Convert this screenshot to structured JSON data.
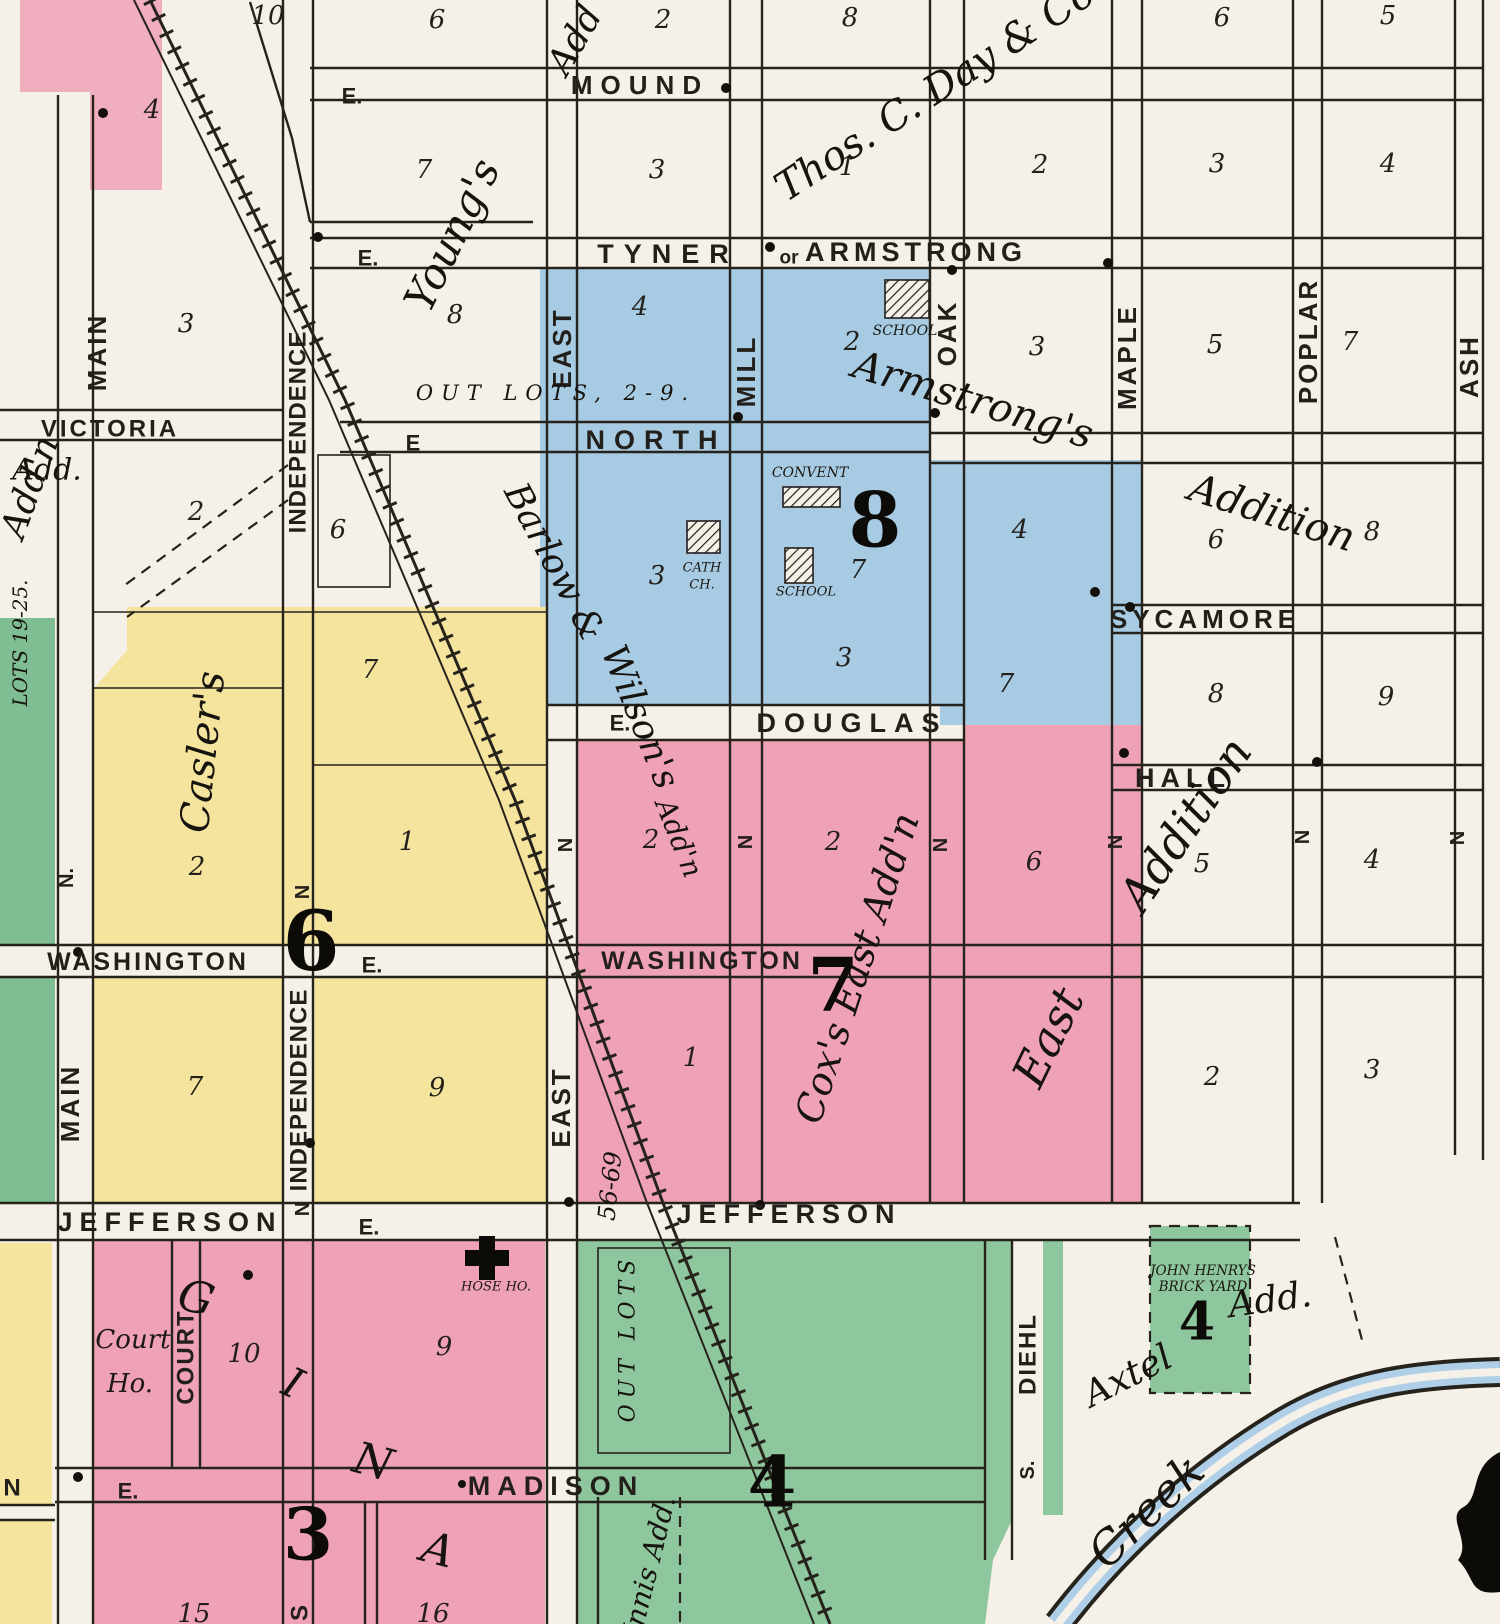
{
  "colors": {
    "paper": "#f5f1e8",
    "pink": "#efa2b6",
    "pink_light": "#f0aebf",
    "blue": "#a6cbe3",
    "yellow": "#f4e49e",
    "green": "#8ec79d",
    "green_strip": "#7fbd92",
    "creek_blue": "#aecfe7",
    "ink": "#231f1a"
  },
  "streets": {
    "mound": "MOUND",
    "tyner": "TYNER",
    "or": "or",
    "armstrong": "ARMSTRONG",
    "north": "NORTH",
    "victoria": "VICTORIA",
    "sycamore": "SYCAMORE",
    "douglas": "DOUGLAS",
    "hall": "HALL",
    "washington_w": "WASHINGTON",
    "washington_e": "WASHINGTON",
    "jefferson_w": "JEFFERSON",
    "jefferson_e": "JEFFERSON",
    "madison": "MADISON",
    "main": "MAIN",
    "independence": "INDEPENDENCE",
    "east": "EAST",
    "mill": "MILL",
    "oak": "OAK",
    "maple": "MAPLE",
    "poplar": "POPLAR",
    "ash": "ASH",
    "court": "COURT",
    "diehl": "DIEHL",
    "s_abbr": "S.",
    "n_abbr": "N.",
    "n": "N",
    "e": "E.",
    "e_plain": "E",
    "n_cut": "N",
    "s_cut": "S"
  },
  "districts": {
    "youngs": "Young's",
    "youngs_add": "Add",
    "thos_day": "Thos. C. Day & Co's",
    "west_addn": "Add'n",
    "victoria_add": "Add.",
    "caslers": "Casler's",
    "barlow": "Barlow &",
    "wilsons": "Wilson's",
    "barlow_addn": "Add'n",
    "armstrongs": "Armstrong's",
    "armstrongs_addition": "Addition",
    "cox": "Cox's East Add'n",
    "east_word": "East",
    "east_addition": "Addition",
    "innis": "Innis Add.",
    "axtel": "Axtel",
    "axtel_add": "Add.",
    "out_lots_2_9": "OUT LOTS, 2-9.",
    "out_lots": "OUT LOTS",
    "lots_19_25": "LOTS 19-25.",
    "lots_56_69": "56-69",
    "creek": "Creek"
  },
  "pois": {
    "school1": "SCHOOL",
    "school2": "SCHOOL",
    "cath1": "CATH",
    "cath2": "CH.",
    "convent": "CONVENT",
    "court1": "Court",
    "court2": "Ho.",
    "hose": "HOSE HO.",
    "brick1": "JOHN HENRYS",
    "brick2": "BRICK YARD"
  },
  "big_numbers": {
    "six": "6",
    "seven": "7",
    "eight": "8",
    "three": "3",
    "four_green": "4",
    "four_axtel": "4"
  },
  "letters": {
    "g": "G",
    "i": "I",
    "n": "N",
    "a": "A"
  },
  "block_numbers": {
    "n1": "10",
    "n2": "6",
    "n3": "2",
    "n4": "8",
    "n5": "6",
    "n6": "5",
    "n7": "4",
    "n8": "7",
    "n9": "3",
    "n10": "1",
    "n11": "2",
    "n12": "3",
    "n13": "4",
    "n14": "8",
    "n15": "4",
    "n16": "2",
    "n17": "3",
    "n18": "5",
    "n19": "7",
    "n20": "3",
    "n21": "2",
    "n22": "6",
    "n23": "3",
    "n24": "7",
    "n25": "3",
    "n26": "4",
    "n27": "6",
    "n28": "8",
    "n29": "7",
    "n30": "7",
    "n31": "8",
    "n32": "9",
    "n33": "2",
    "n34": "2",
    "n35": "6",
    "n36": "5",
    "n37": "4",
    "n38": "2",
    "n39": "1",
    "n40": "7",
    "n41": "9",
    "n42": "1",
    "n43": "2",
    "n44": "3",
    "n45": "10",
    "n46": "9",
    "n47": "15",
    "n48": "16"
  }
}
